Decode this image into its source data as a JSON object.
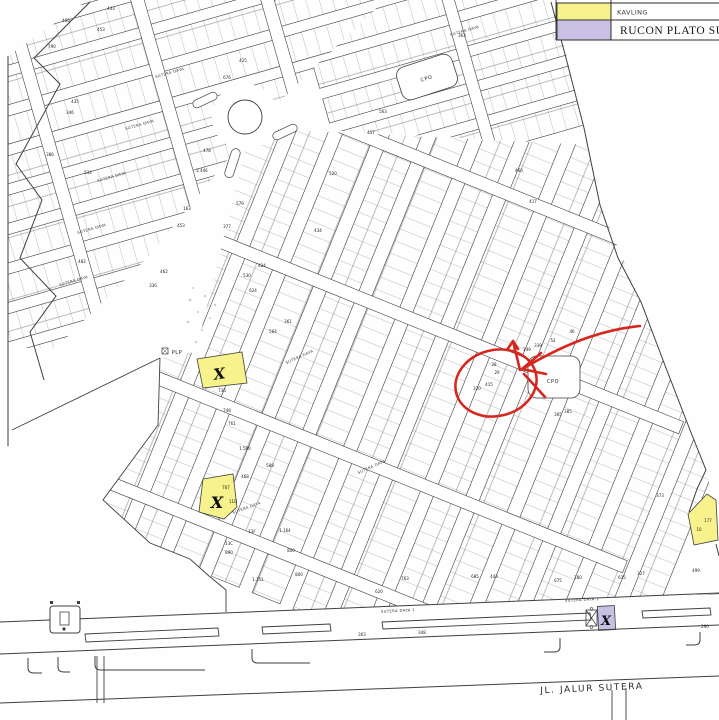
{
  "legend": {
    "items": [
      {
        "label": "KAVLING",
        "color": "#f7f28c"
      },
      {
        "label": "RUCON PLATO SUDUT",
        "color": "#c9c1e4"
      }
    ]
  },
  "annotation": {
    "color": "#d5271d"
  },
  "map": {
    "road_label": "JL. JALUR SUTERA",
    "facility_labels": [
      {
        "t": "CPO",
        "x": 427,
        "y": 80,
        "r": -18
      },
      {
        "t": "CPO",
        "x": 553,
        "y": 383,
        "r": 0
      },
      {
        "t": "PLP",
        "x": 177,
        "y": 354,
        "r": 0,
        "s": 4
      }
    ],
    "street_labels": [
      {
        "t": "SUTERA DAYA",
        "x": 170,
        "y": 74,
        "r": -16
      },
      {
        "t": "SUTERA DAYA",
        "x": 140,
        "y": 126,
        "r": -16
      },
      {
        "t": "SUTERA DAYA",
        "x": 112,
        "y": 178,
        "r": -16
      },
      {
        "t": "SUTERA DAYA",
        "x": 92,
        "y": 230,
        "r": -16
      },
      {
        "t": "SUTERA DAYA",
        "x": 74,
        "y": 282,
        "r": -16
      },
      {
        "t": "SUTERA DAYA",
        "x": 465,
        "y": 32,
        "r": -16
      },
      {
        "t": "SUTERA DAYA",
        "x": 300,
        "y": 358,
        "r": -24
      },
      {
        "t": "SUTERA DAYA",
        "x": 372,
        "y": 468,
        "r": -24
      },
      {
        "t": "SUTERA DAYA",
        "x": 247,
        "y": 509,
        "r": -20
      },
      {
        "t": "SUTERA DAYA 1",
        "x": 398,
        "y": 612,
        "r": -3
      },
      {
        "t": "SUTERA DAYA 1",
        "x": 582,
        "y": 601,
        "r": -3
      }
    ],
    "x_marks": [
      {
        "t": "X",
        "x": 220,
        "y": 379,
        "s": 15,
        "r": -8
      },
      {
        "t": "X",
        "x": 217,
        "y": 508,
        "s": 16,
        "r": 0
      },
      {
        "t": "X",
        "x": 606,
        "y": 625,
        "s": 13,
        "r": 0
      }
    ],
    "plot_numbers": [
      {
        "t": "405",
        "x": 66,
        "y": 22
      },
      {
        "t": "443",
        "x": 111,
        "y": 10
      },
      {
        "t": "453",
        "x": 101,
        "y": 31
      },
      {
        "t": "790",
        "x": 52,
        "y": 48
      },
      {
        "t": "425",
        "x": 243,
        "y": 62
      },
      {
        "t": "676",
        "x": 227,
        "y": 79
      },
      {
        "t": "435",
        "x": 75,
        "y": 103
      },
      {
        "t": "346",
        "x": 70,
        "y": 114
      },
      {
        "t": "386",
        "x": 50,
        "y": 156
      },
      {
        "t": "534",
        "x": 88,
        "y": 174
      },
      {
        "t": "478",
        "x": 207,
        "y": 152
      },
      {
        "t": "2.446",
        "x": 202,
        "y": 172
      },
      {
        "t": "163",
        "x": 187,
        "y": 210
      },
      {
        "t": "453",
        "x": 181,
        "y": 227
      },
      {
        "t": "482",
        "x": 82,
        "y": 263
      },
      {
        "t": "462",
        "x": 164,
        "y": 273
      },
      {
        "t": "336",
        "x": 153,
        "y": 287
      },
      {
        "t": "363",
        "x": 462,
        "y": 37
      },
      {
        "t": "563",
        "x": 383,
        "y": 113
      },
      {
        "t": "457",
        "x": 371,
        "y": 134
      },
      {
        "t": "460",
        "x": 519,
        "y": 172
      },
      {
        "t": "417",
        "x": 533,
        "y": 203
      },
      {
        "t": "579",
        "x": 240,
        "y": 205
      },
      {
        "t": "377",
        "x": 227,
        "y": 228
      },
      {
        "t": "520",
        "x": 333,
        "y": 175
      },
      {
        "t": "434",
        "x": 318,
        "y": 232
      },
      {
        "t": "424",
        "x": 262,
        "y": 267
      },
      {
        "t": "530",
        "x": 247,
        "y": 277
      },
      {
        "t": "564",
        "x": 273,
        "y": 333
      },
      {
        "t": "361",
        "x": 288,
        "y": 323
      },
      {
        "t": "624",
        "x": 253,
        "y": 292
      },
      {
        "t": "249",
        "x": 527,
        "y": 351
      },
      {
        "t": "339",
        "x": 538,
        "y": 347
      },
      {
        "t": "46",
        "x": 572,
        "y": 333
      },
      {
        "t": "52",
        "x": 553,
        "y": 342
      },
      {
        "t": "28",
        "x": 494,
        "y": 366
      },
      {
        "t": "29",
        "x": 497,
        "y": 374
      },
      {
        "t": "415",
        "x": 489,
        "y": 386
      },
      {
        "t": "320",
        "x": 477,
        "y": 390
      },
      {
        "t": "365",
        "x": 558,
        "y": 416
      },
      {
        "t": "385",
        "x": 568,
        "y": 413
      },
      {
        "t": "736",
        "x": 222,
        "y": 392
      },
      {
        "t": "748",
        "x": 227,
        "y": 412
      },
      {
        "t": "761",
        "x": 232,
        "y": 425
      },
      {
        "t": "1.590",
        "x": 245,
        "y": 450
      },
      {
        "t": "588",
        "x": 270,
        "y": 467
      },
      {
        "t": "468",
        "x": 245,
        "y": 478
      },
      {
        "t": "767",
        "x": 226,
        "y": 489
      },
      {
        "t": "11D",
        "x": 233,
        "y": 503
      },
      {
        "t": "13F",
        "x": 252,
        "y": 533
      },
      {
        "t": "13C",
        "x": 229,
        "y": 545
      },
      {
        "t": "890",
        "x": 229,
        "y": 554
      },
      {
        "t": "1.151",
        "x": 258,
        "y": 581,
        "s": 5
      },
      {
        "t": "1.164",
        "x": 285,
        "y": 532
      },
      {
        "t": "800",
        "x": 291,
        "y": 552
      },
      {
        "t": "800",
        "x": 299,
        "y": 576
      },
      {
        "t": "763",
        "x": 405,
        "y": 580
      },
      {
        "t": "620",
        "x": 379,
        "y": 593
      },
      {
        "t": "685",
        "x": 475,
        "y": 578
      },
      {
        "t": "443",
        "x": 494,
        "y": 578
      },
      {
        "t": "675",
        "x": 558,
        "y": 582
      },
      {
        "t": "280",
        "x": 578,
        "y": 579
      },
      {
        "t": "615",
        "x": 622,
        "y": 579
      },
      {
        "t": "327",
        "x": 641,
        "y": 575
      },
      {
        "t": "499",
        "x": 696,
        "y": 572
      },
      {
        "t": "348",
        "x": 422,
        "y": 634
      },
      {
        "t": "363",
        "x": 362,
        "y": 636
      },
      {
        "t": "290",
        "x": 705,
        "y": 628
      },
      {
        "t": "373",
        "x": 660,
        "y": 497
      },
      {
        "t": "177",
        "x": 708,
        "y": 522
      },
      {
        "t": "10",
        "x": 699,
        "y": 531
      }
    ]
  }
}
